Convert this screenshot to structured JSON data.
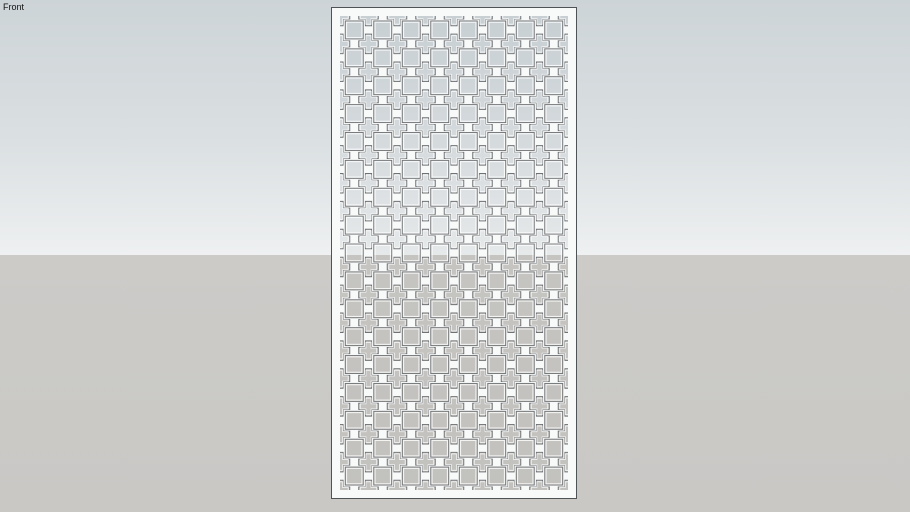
{
  "viewport": {
    "label": "Front"
  },
  "scene": {
    "canvas": {
      "width": 910,
      "height": 512
    },
    "background": {
      "horizon_y": 255,
      "sky_top": "#cdd4d7",
      "sky_mid": "#dbe0e2",
      "sky_horizon": "#eef0f1",
      "ground_top": "#cccbc8",
      "ground_bottom": "#c9c8c5"
    },
    "panel": {
      "x": 331,
      "y": 7,
      "width": 246,
      "height": 492,
      "margin": 9,
      "fill": "#f8f9f9",
      "outline": "#4e5456",
      "pattern": {
        "columns": 8,
        "rows": 17,
        "square_size": 18,
        "cross_span": 19.6,
        "cross_arm_width": 6.2,
        "hole_outline": "#6f7274",
        "hole_rim": "rgba(255,255,255,0.8)",
        "hole_sky_top": "#c6ced2",
        "hole_sky_mid": "#d5dadd",
        "hole_sky_horizon": "#e6e9ea",
        "hole_ground_top": "#c5c4c1",
        "hole_ground_bottom": "#c2c1be"
      }
    }
  }
}
